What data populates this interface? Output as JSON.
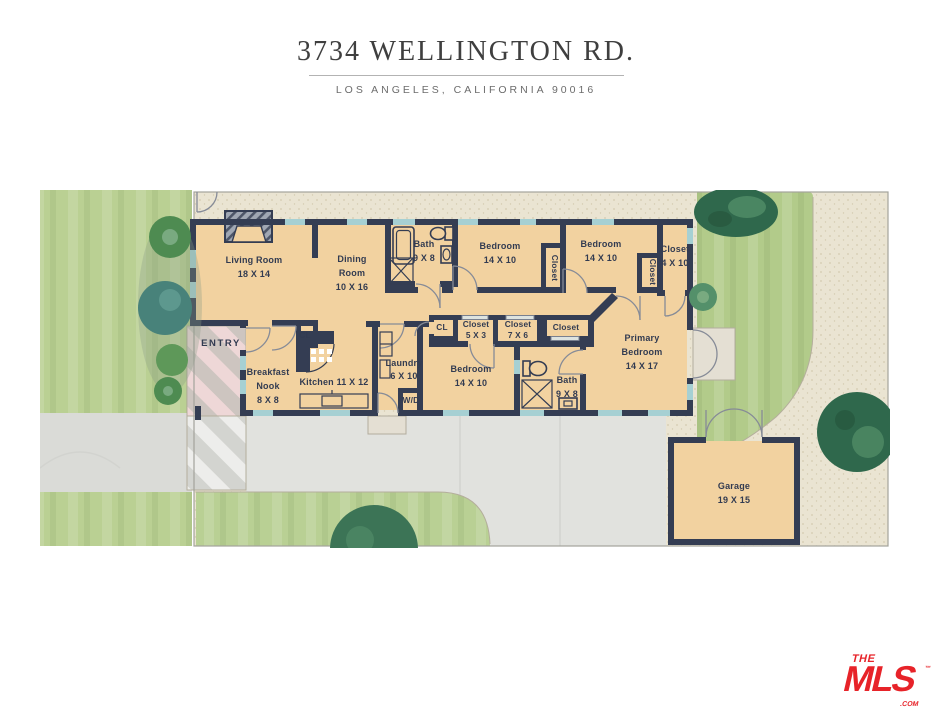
{
  "header": {
    "title": "3734 WELLINGTON RD.",
    "subtitle": "LOS ANGELES, CALIFORNIA  90016"
  },
  "logo": {
    "the": "THE",
    "mls": "MLS",
    "com": ".COM",
    "tm": "™"
  },
  "colors": {
    "floor": "#f2d2a0",
    "wall": "#343d53",
    "window": "#a6d0d3",
    "path": "#eae4d2",
    "lawn": "#bad093",
    "lawnBack": "#b2cb8a",
    "lawnFront": "#b9d094",
    "drive": "#e1e2de",
    "driveLeft": "#dadbd7",
    "stripePink": "#eed7d7",
    "stripeWarm": "#cdc5c0",
    "stripeLight": "#ededeb",
    "stripeGrayL": "#d3d4d0",
    "patio": "#e4dfd3",
    "border": "#a3a39b",
    "treeDark": "#2f684c",
    "treeMid": "#54906a",
    "treeLight": "#79aa80",
    "teal": "#48827a",
    "palm": "#4e8b51",
    "ink": "#3f3f3f",
    "sub": "#6c6c6c",
    "labelInk": "#323b51",
    "red": "#e72329"
  },
  "rooms": {
    "living": [
      "Living Room",
      "18 X 14"
    ],
    "dining": [
      "Dining",
      "Room",
      "10 X 16"
    ],
    "bath1": [
      "Bath",
      "9 X 8"
    ],
    "bedroom1": [
      "Bedroom",
      "14 X 10"
    ],
    "closet1": [
      "Closet"
    ],
    "bedroom2": [
      "Bedroom",
      "14 X 10"
    ],
    "closet2": [
      "Closet"
    ],
    "closet410": [
      "Closet",
      "4 X 10"
    ],
    "entry": [
      "ENTRY"
    ],
    "breakfast": [
      "Breakfast",
      "Nook",
      "8 X 8"
    ],
    "cl_kitchen": [
      "CL"
    ],
    "kitchen": [
      "Kitchen 11 X 12"
    ],
    "laundry": [
      "Laundry",
      "6 X 10"
    ],
    "wd": [
      "W/D"
    ],
    "cl_hall": [
      "CL"
    ],
    "closet53": [
      "Closet",
      "5 X 3"
    ],
    "closet76": [
      "Closet",
      "7 X 6"
    ],
    "closetPlain": [
      "Closet"
    ],
    "bedroom3": [
      "Bedroom",
      "14 X 10"
    ],
    "bath2": [
      "Bath",
      "9 X 8"
    ],
    "primary": [
      "Primary",
      "Bedroom",
      "14 X 17"
    ],
    "garage": [
      "Garage",
      "19 X 15"
    ]
  }
}
